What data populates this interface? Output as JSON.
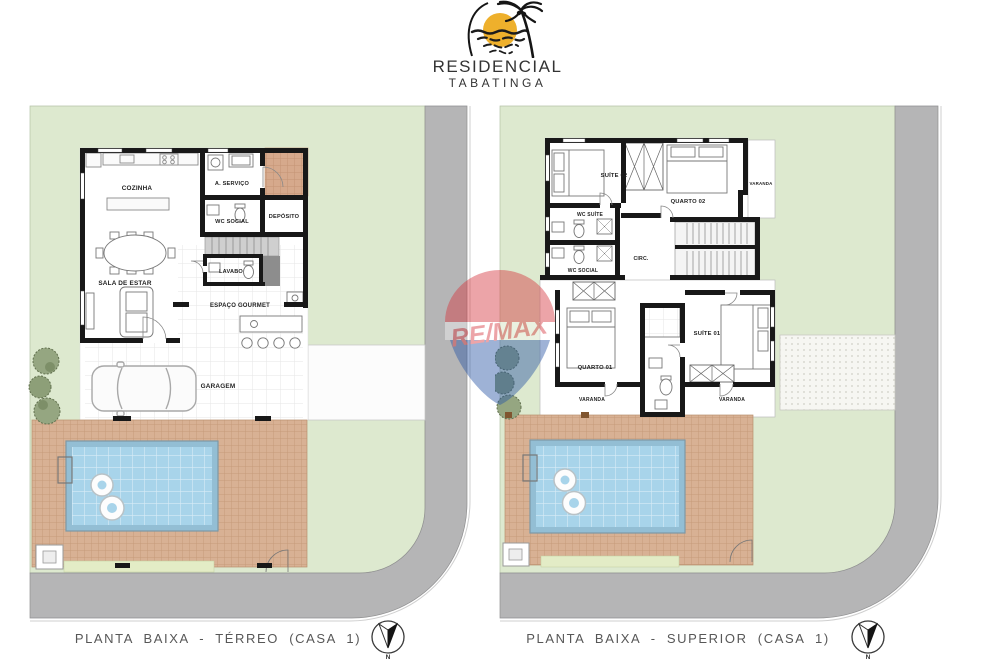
{
  "logo": {
    "name": "RESIDENCIAL",
    "place": "TABATINGA"
  },
  "watermark": {
    "brand": "RE/MAX"
  },
  "compass": {
    "north": "N"
  },
  "colors": {
    "lawn": "#dde9cf",
    "road": "#b5b5b6",
    "deck": "#d8b194",
    "entry_paving": "#d6a98c",
    "pool_water": "#a8d4ea",
    "pool_border": "#93bed4",
    "wall": "#181818",
    "remax_red": "#d6383f",
    "remax_blue": "#2b57a5",
    "logo_sun": "#eeb02c"
  },
  "plans": {
    "terreo": {
      "caption": "PLANTA BAIXA - TÉRREO (CASA 1)",
      "rooms": {
        "cozinha": "COZINHA",
        "servico": "A. SERVIÇO",
        "wc_social": "WC SOCIAL",
        "deposito": "DEPÓSITO",
        "lavabo": "LAVABO",
        "sala": "SALA DE ESTAR",
        "gourmet": "ESPAÇO GOURMET",
        "garagem": "GARAGEM"
      }
    },
    "superior": {
      "caption": "PLANTA BAIXA - SUPERIOR (CASA 1)",
      "rooms": {
        "suite02": "SUÍTE 02",
        "quarto02": "QUARTO 02",
        "varanda_superior": "VARANDA",
        "wc_suite": "WC SUÍTE",
        "wc_social": "WC SOCIAL",
        "circ": "CIRC.",
        "quarto01": "QUARTO 01",
        "suite01": "SUÍTE 01",
        "varanda_esquerda": "VARANDA",
        "varanda_direita": "VARANDA"
      }
    }
  }
}
